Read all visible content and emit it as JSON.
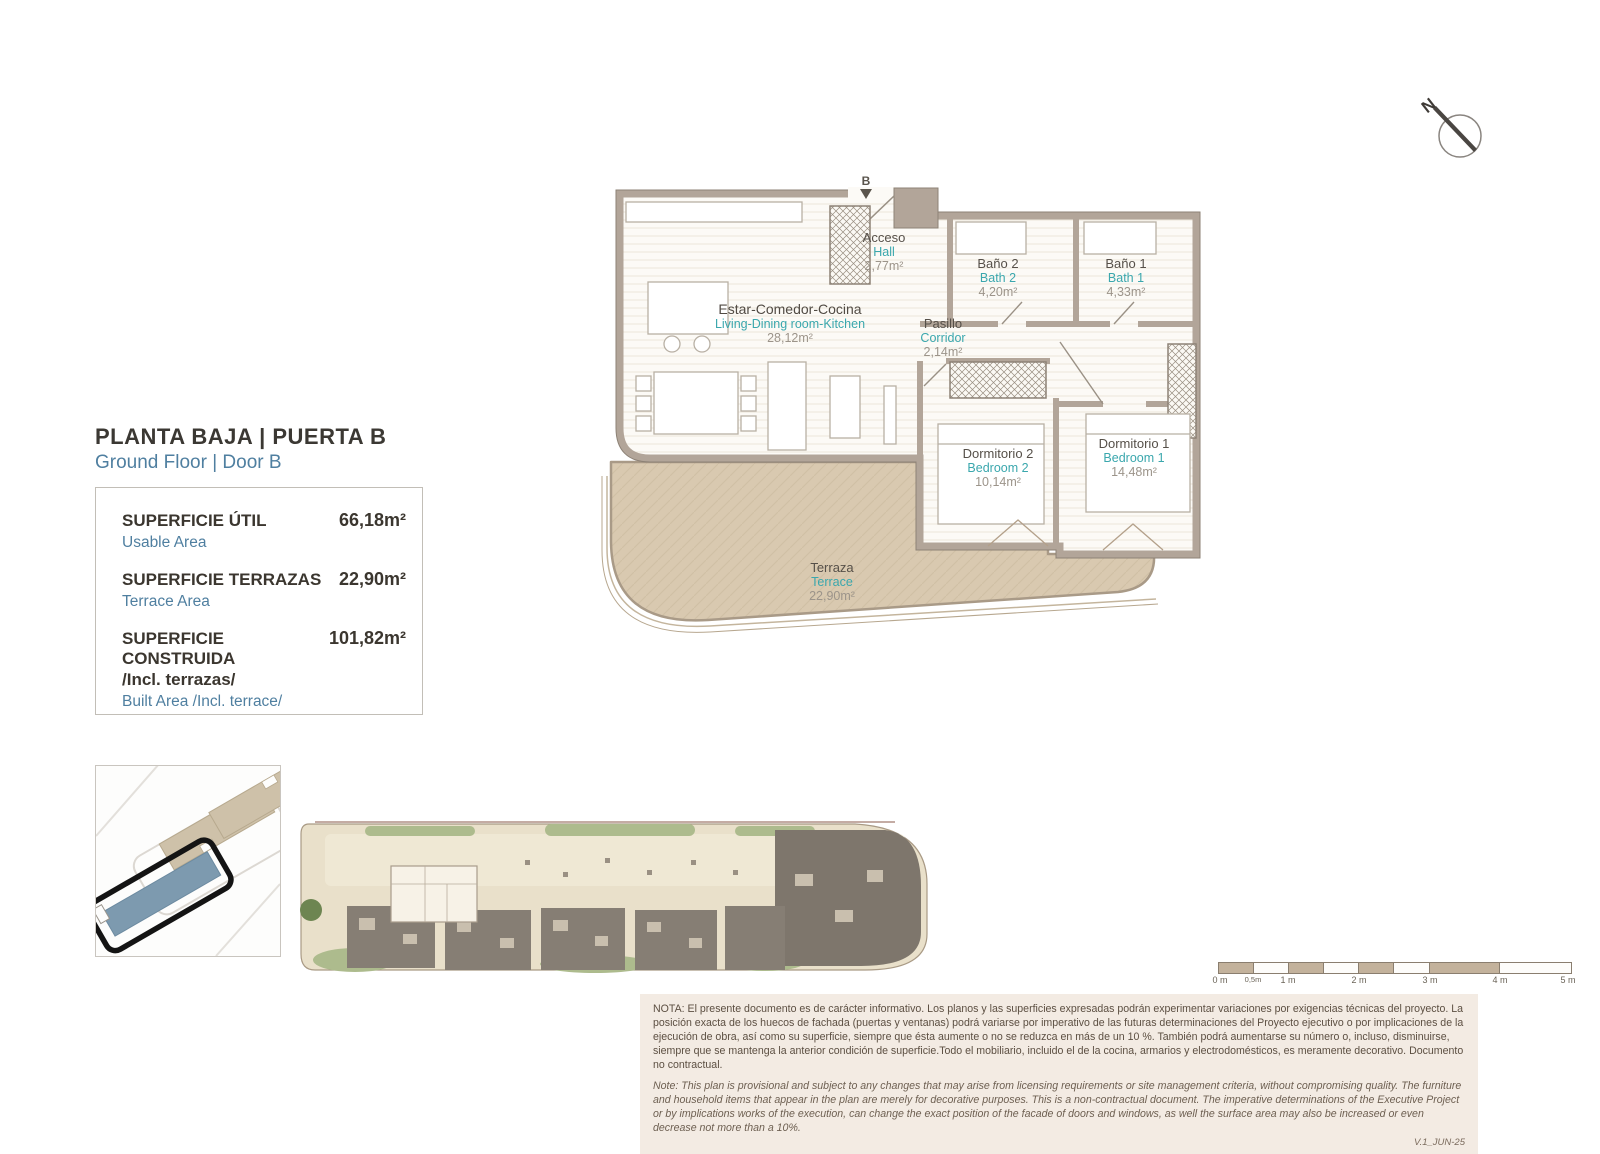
{
  "header": {
    "title_es": "PLANTA BAJA | PUERTA B",
    "title_en": "Ground Floor | Door B"
  },
  "areas_table": {
    "rows": [
      {
        "label_es": "SUPERFICIE ÚTIL",
        "label_en": "Usable Area",
        "value": "66,18m²"
      },
      {
        "label_es": "SUPERFICIE TERRAZAS",
        "label_en": "Terrace Area",
        "value": "22,90m²"
      },
      {
        "label_es": "SUPERFICIE CONSTRUIDA",
        "label_es2": "/Incl. terrazas/",
        "label_en": "Built Area /Incl. terrace/",
        "value": "101,82m²"
      }
    ]
  },
  "plan": {
    "entry_marker": "B",
    "compass_label": "N",
    "rooms": [
      {
        "id": "hall",
        "name_es": "Acceso",
        "name_en": "Hall",
        "area": "2,77m²"
      },
      {
        "id": "bath2",
        "name_es": "Baño 2",
        "name_en": "Bath 2",
        "area": "4,20m²"
      },
      {
        "id": "bath1",
        "name_es": "Baño 1",
        "name_en": "Bath 1",
        "area": "4,33m²"
      },
      {
        "id": "living",
        "name_es": "Estar-Comedor-Cocina",
        "name_en": "Living-Dining room-Kitchen",
        "area": "28,12m²"
      },
      {
        "id": "corridor",
        "name_es": "Pasillo",
        "name_en": "Corridor",
        "area": "2,14m²"
      },
      {
        "id": "bedroom2",
        "name_es": "Dormitorio 2",
        "name_en": "Bedroom 2",
        "area": "10,14m²"
      },
      {
        "id": "bedroom1",
        "name_es": "Dormitorio 1",
        "name_en": "Bedroom 1",
        "area": "14,48m²"
      },
      {
        "id": "terrace",
        "name_es": "Terraza",
        "name_en": "Terrace",
        "area": "22,90m²"
      }
    ]
  },
  "scale_bar": {
    "labels": [
      "0 m",
      "0,5m",
      "1 m",
      "2 m",
      "3 m",
      "4 m",
      "5 m"
    ]
  },
  "notes": {
    "es": "NOTA: El presente documento es de carácter informativo. Los planos y las superficies expresadas podrán experimentar variaciones por exigencias técnicas del proyecto. La posición exacta de los huecos de fachada (puertas y ventanas) podrá variarse por imperativo de las futuras determinaciones del Proyecto ejecutivo o por implicaciones de la ejecución de obra, así como su superficie, siempre que ésta aumente o no se reduzca en más de un 10 %. También podrá aumentarse su número o, incluso, disminuirse, siempre que se mantenga la anterior condición de superficie.Todo el mobiliario, incluido el de la cocina, armarios y electrodomésticos, es meramente decorativo. Documento no contractual.",
    "en": "Note: This plan is provisional and subject to any changes that may arise from licensing requirements or site management criteria, without compromising quality. The furniture and household items that appear in the plan are merely for decorative purposes. This is a non-contractual document. The imperative determinations of the Executive Project or by implications works of the execution, can change the exact position of the facade of doors and windows, as well the surface area may also be increased or even decrease not more than a 10%.",
    "version": "V.1_JUN-25"
  },
  "colors": {
    "wall": "#b2a599",
    "wall_edge": "#8d8276",
    "terrace": "#d9c9b0",
    "teal_accent": "#3aa7ad",
    "blue_accent": "#4f7fa0",
    "highlight_building": "#7d9aaf"
  }
}
